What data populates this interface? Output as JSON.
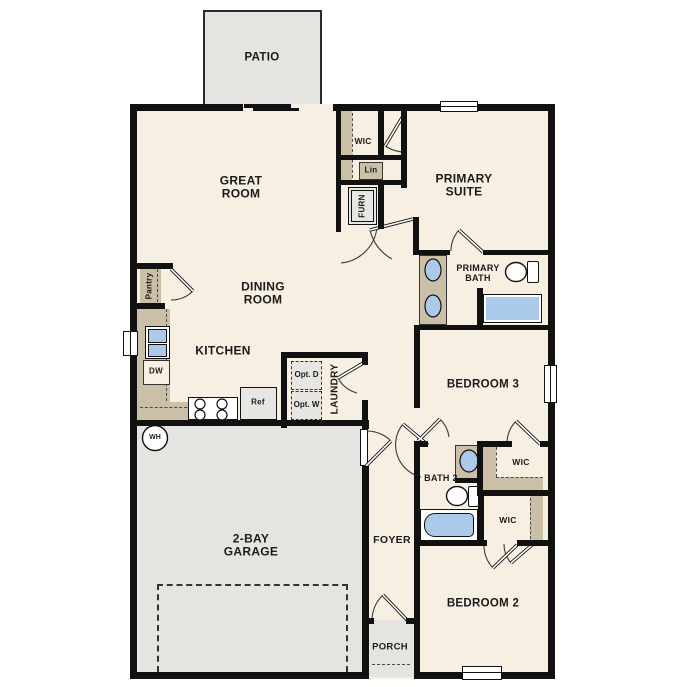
{
  "plan_title": "Single-story floor plan",
  "labels": {
    "patio": "PATIO",
    "great_room": "GREAT ROOM",
    "wic_primary": "WIC",
    "lin": "Lin",
    "furn": "FURN",
    "primary_suite": "PRIMARY SUITE",
    "primary_bath": "PRIMARY BATH",
    "dining_room": "DINING ROOM",
    "kitchen": "KITCHEN",
    "pantry": "Pantry",
    "dw": "DW",
    "ref": "Ref",
    "opt_d": "Opt. D",
    "opt_w": "Opt. W",
    "laundry": "LAUNDRY",
    "wh": "WH",
    "bedroom3": "BEDROOM 3",
    "wic_bed3": "WIC",
    "bath2": "BATH 2",
    "wic_bed2": "WIC",
    "garage": "2-BAY GARAGE",
    "foyer": "FOYER",
    "bedroom2": "BEDROOM 2",
    "porch": "PORCH"
  },
  "colors": {
    "floor": "#F6EFE2",
    "exterior_zone_gray": "#E5E4E1",
    "counter_tan": "#CCBFA7",
    "fixture_blue": "#ABC9E9",
    "wall_black": "#111111"
  }
}
